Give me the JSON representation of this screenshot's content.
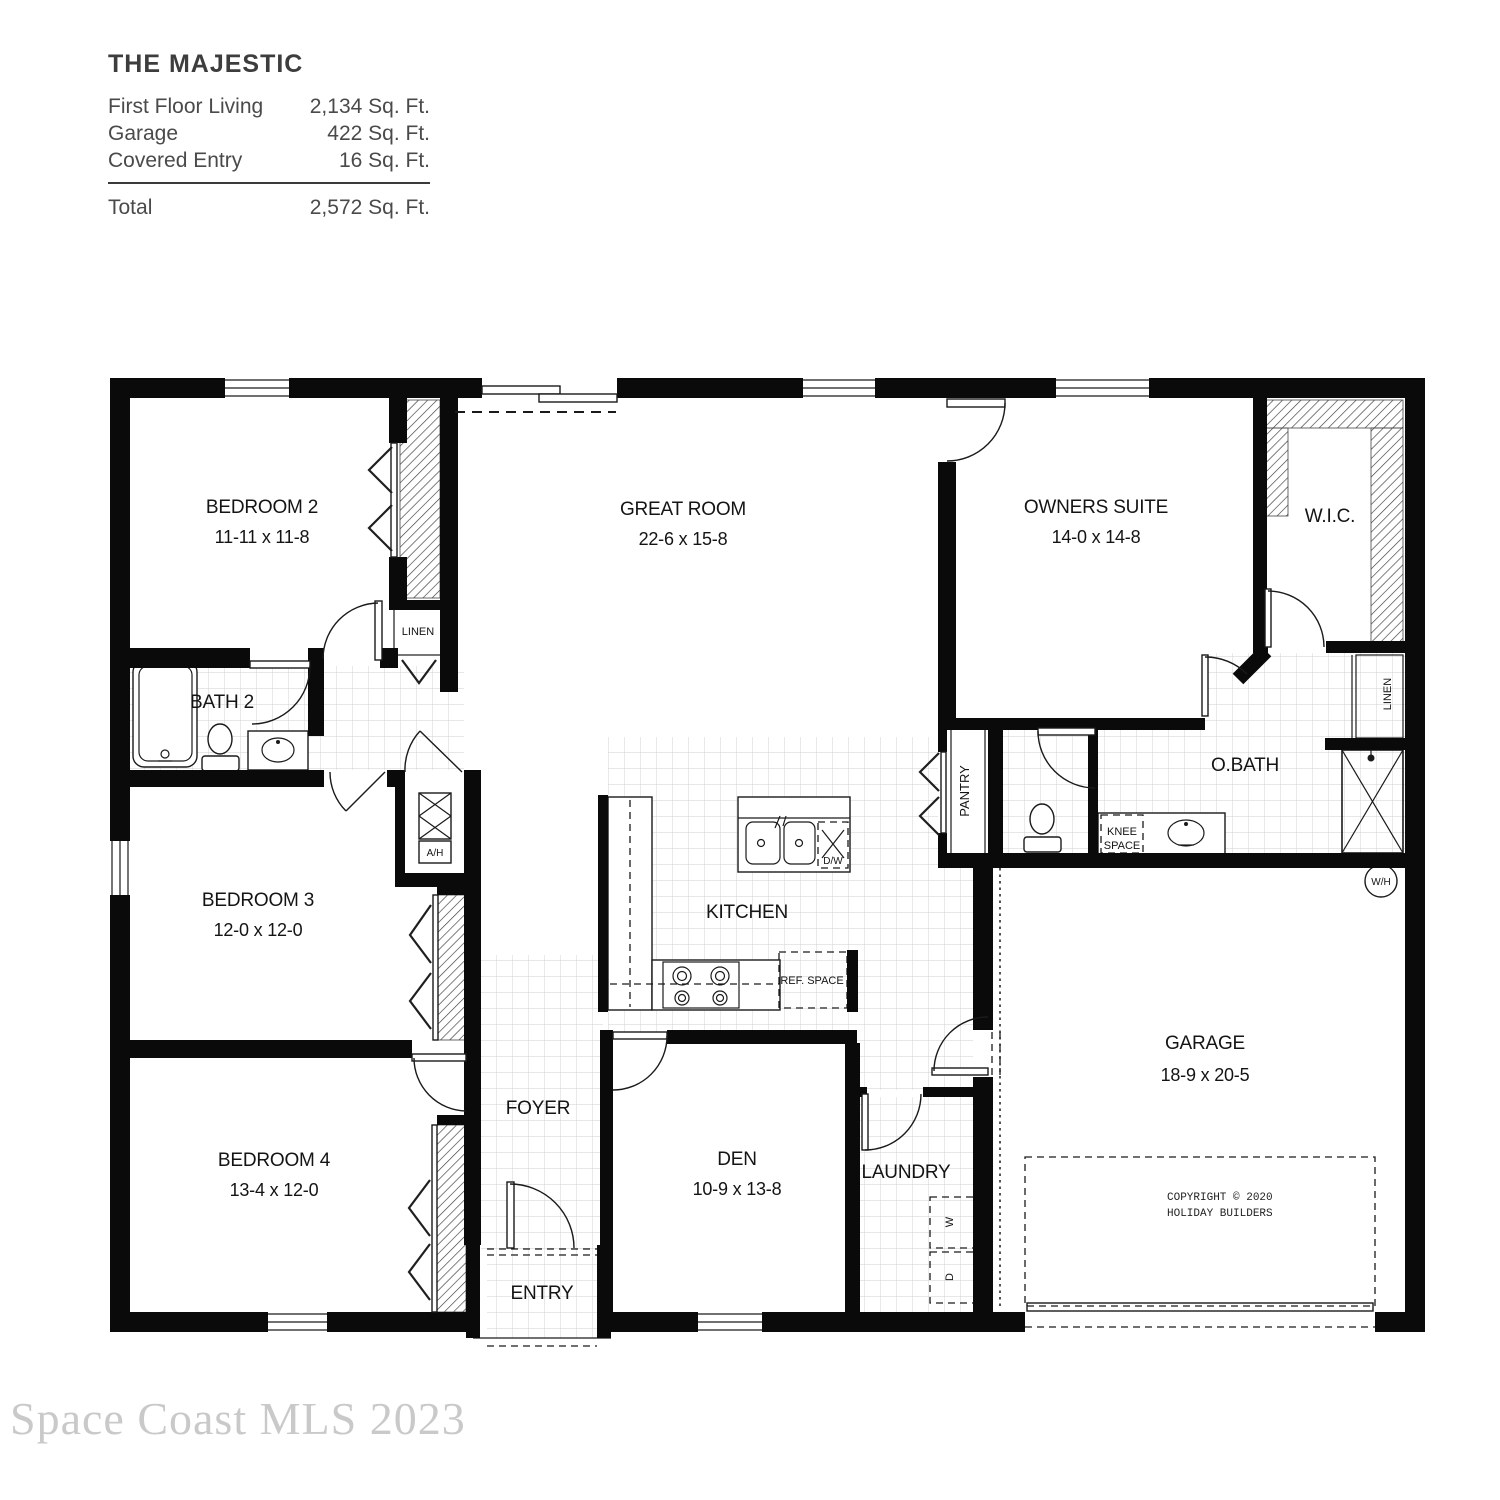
{
  "title_block": {
    "title": "THE MAJESTIC",
    "rows": [
      {
        "label": "First Floor Living",
        "value": "2,134 Sq. Ft."
      },
      {
        "label": "Garage",
        "value": "422 Sq. Ft."
      },
      {
        "label": "Covered Entry",
        "value": "16 Sq. Ft."
      }
    ],
    "total": {
      "label": "Total",
      "value": "2,572 Sq. Ft."
    }
  },
  "rooms": {
    "bedroom2": {
      "name": "BEDROOM 2",
      "dims": "11-11 x 11-8"
    },
    "great_room": {
      "name": "GREAT ROOM",
      "dims": "22-6 x 15-8"
    },
    "owners_suite": {
      "name": "OWNERS SUITE",
      "dims": "14-0 x 14-8"
    },
    "wic": {
      "name": "W.I.C."
    },
    "bath2": {
      "name": "BATH 2"
    },
    "obath": {
      "name": "O.BATH"
    },
    "bedroom3": {
      "name": "BEDROOM 3",
      "dims": "12-0 x 12-0"
    },
    "kitchen": {
      "name": "KITCHEN"
    },
    "bedroom4": {
      "name": "BEDROOM 4",
      "dims": "13-4 x 12-0"
    },
    "foyer": {
      "name": "FOYER"
    },
    "den": {
      "name": "DEN",
      "dims": "10-9 x 13-8"
    },
    "laundry": {
      "name": "LAUNDRY"
    },
    "garage": {
      "name": "GARAGE",
      "dims": "18-9 x 20-5"
    },
    "entry": {
      "name": "ENTRY"
    }
  },
  "fixtures": {
    "linen_hall": "LINEN",
    "linen_suite": "LINEN",
    "pantry": "PANTRY",
    "knee_line1": "KNEE",
    "knee_line2": "SPACE",
    "air_handler": "A/H",
    "dishwasher": "D/W",
    "ref_space": "REF. SPACE",
    "water_heater": "W/H",
    "washer": "W",
    "dryer": "D"
  },
  "copyright": {
    "line1": "COPYRIGHT © 2020",
    "line2": "HOLIDAY BUILDERS"
  },
  "watermark": "Space Coast MLS 2023"
}
